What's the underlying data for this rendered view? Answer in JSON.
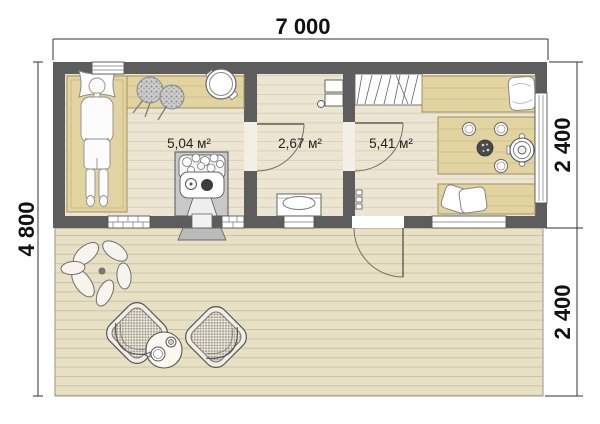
{
  "dimensions": {
    "top": "7 000",
    "left": "4 800",
    "right_top": "2 400",
    "right_bottom": "2 400"
  },
  "rooms": {
    "sauna": {
      "area": "5,04 м²"
    },
    "washroom": {
      "area": "2,67 м²"
    },
    "lounge": {
      "area": "5,41 м²"
    }
  },
  "colors": {
    "wall": "#5d5d5d",
    "room_floor": "#ece5d2",
    "bench_wood": "#e2d4a0",
    "terrace_deck": "#e8e0c4",
    "dimension_text": "#111111"
  }
}
